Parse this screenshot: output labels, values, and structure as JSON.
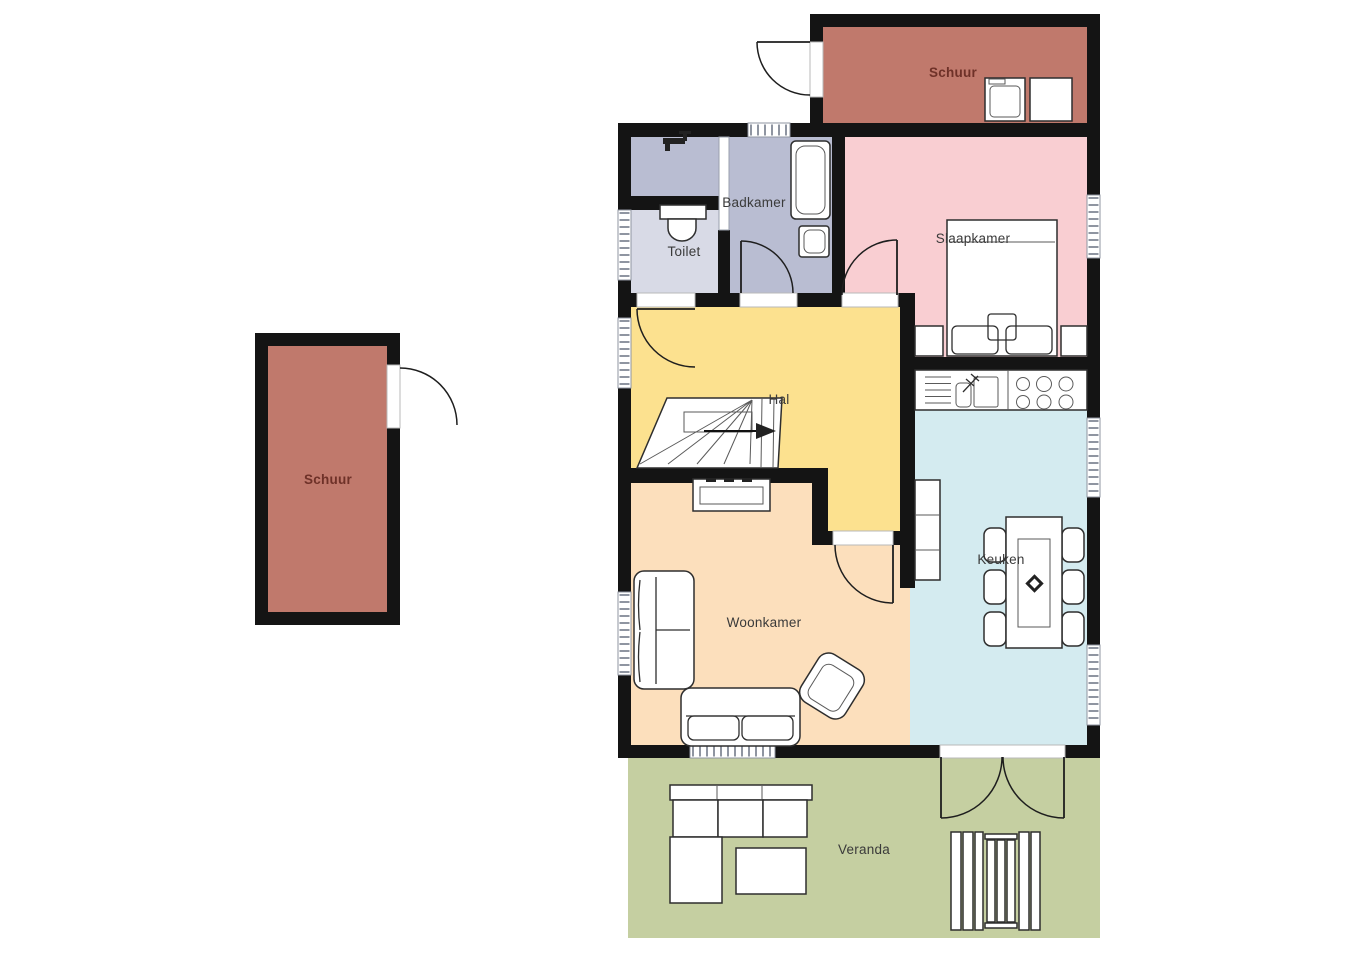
{
  "palette": {
    "wall": "#141414",
    "background": "#ffffff",
    "furniture_line": "#2e2e2e",
    "window_line": "#8f95a1",
    "door_line": "#1e1e1e",
    "room_label": "#3a3a3a",
    "schuur_label": "#6e3128"
  },
  "rooms": {
    "schuur_left": {
      "label": "Schuur",
      "color": "#c0796c"
    },
    "schuur_top": {
      "label": "Schuur",
      "color": "#c0796c"
    },
    "badkamer": {
      "label": "Badkamer",
      "color": "#b9bdd2"
    },
    "toilet": {
      "label": "Toilet",
      "color": "#d8dae6"
    },
    "slaapkamer": {
      "label": "Slaapkamer",
      "color": "#f9ced2"
    },
    "hal": {
      "label": "Hal",
      "color": "#fce18f"
    },
    "woonkamer": {
      "label": "Woonkamer",
      "color": "#fcdfbc"
    },
    "keuken": {
      "label": "Keuken",
      "color": "#d4ebf0"
    },
    "veranda": {
      "label": "Veranda",
      "color": "#c5cfa1"
    }
  },
  "icons": {
    "staircase": "stairs-with-up-arrow",
    "bed": "double-bed-top-view",
    "bathtub": "bathtub",
    "toilet_fixture": "toilet-bowl-with-cistern",
    "washbasin": "washbasin",
    "tap": "faucet",
    "washing_machine": "washing-machine",
    "dryer": "appliance-box",
    "kitchen_sink": "sink-with-faucet",
    "stove": "six-burner-hob",
    "dining_table": "table-with-six-chairs",
    "plant": "table-plant",
    "tv_cabinet": "sideboard",
    "sofa": "sofa-top-view",
    "armchair": "armchair-top-view",
    "outdoor_sofa": "corner-garden-sofa",
    "coffee_table": "coffee-table",
    "garden_set": "slatted-garden-set",
    "door_swing": "quarter-circle-door-arc",
    "window": "hatched-window-band"
  }
}
